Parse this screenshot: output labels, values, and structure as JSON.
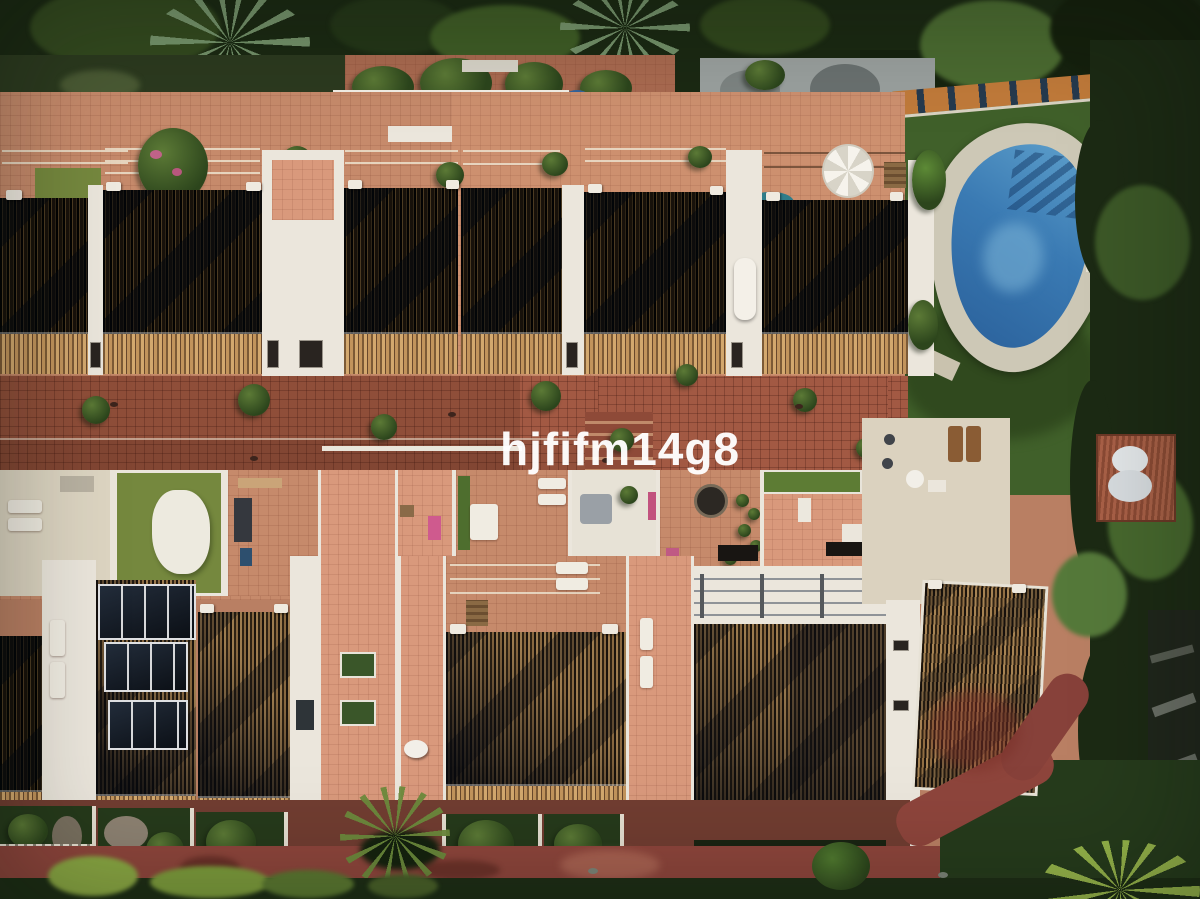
{
  "meta": {
    "type": "aerial drone photograph",
    "subject": "Mediterranean townhouse complex with rooftop terraces, brick walkway, communal kidney-shaped pool and gardens",
    "width_px": 1200,
    "height_px": 899
  },
  "watermark": {
    "text": "hjfifm14g8",
    "color": "#ffffff"
  },
  "palette": {
    "tree_canopy": "#1b2913",
    "lawn": "#40602a",
    "pool_water": "#3a7ab3",
    "pool_deck": "#cdc8b6",
    "terracotta_terrace": "#c68a6b",
    "brick_walkway": "#a25943",
    "dark_roof": "#17110b",
    "sunlit_roof_tiles": "#9c7a4e",
    "white_walls": "#ebe6dc",
    "red_path": "#8e453c",
    "solar_panel": "#11161e",
    "hedge": "#1c2a14",
    "orange_wall_cap": "#c07a3a",
    "turf_terrace": "#75883e",
    "pink_furniture": "#cf5a8e"
  },
  "scene": {
    "regions": [
      "tree canopy band across top",
      "upper row of townhouses with dark tiled roofs and terracotta roof terraces",
      "central brick pedestrian walkway with potted bushes",
      "lower row of townhouses with solar panels and sunlit tiled roofs",
      "communal lawn with kidney-shaped swimming pool on the right",
      "front gardens and red footpath along the bottom"
    ]
  }
}
